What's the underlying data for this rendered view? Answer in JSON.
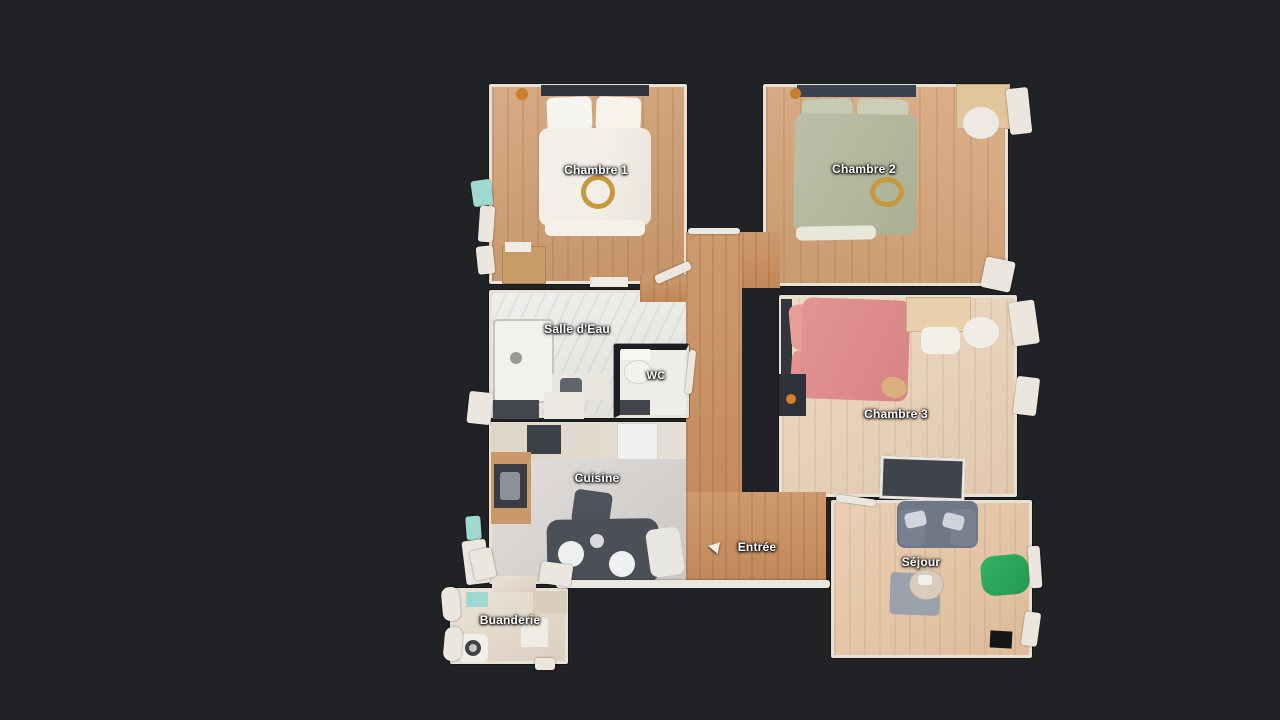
{
  "view": {
    "type": "3d-dollhouse-floorplan-top-view",
    "background": "#212226"
  },
  "rooms": [
    {
      "id": "chambre-1",
      "label": "Chambre 1",
      "floor": "#cf9b6d"
    },
    {
      "id": "chambre-2",
      "label": "Chambre 2",
      "floor": "#d6a478"
    },
    {
      "id": "salle-deau",
      "label": "Salle d'Eau",
      "floor": "#e9e7e3"
    },
    {
      "id": "wc",
      "label": "WC",
      "floor": "#efede8"
    },
    {
      "id": "cuisine",
      "label": "Cuisine",
      "floor": "#d8d4d1"
    },
    {
      "id": "chambre-3",
      "label": "Chambre 3",
      "floor": "#e9cfb4"
    },
    {
      "id": "entree",
      "label": "Entrée",
      "floor": "#c88e5d"
    },
    {
      "id": "sejour",
      "label": "Séjour",
      "floor": "#e6c3a1"
    },
    {
      "id": "buanderie",
      "label": "Buanderie",
      "floor": "#e4d8ca"
    }
  ],
  "palette": {
    "background": "#212226",
    "wall": "#e8e2d6",
    "bed_chambre1": "#efebe4",
    "bed_chambre2": "#b5b9a1",
    "bed_chambre3": "#de8d8c",
    "headboard_dark": "#3a4150",
    "sofa": "#6e7887",
    "pouf_green": "#2baa5e",
    "rug": "#9aa1ab",
    "kitchen_table": "#4b5057",
    "decor_gold": "#c6993f",
    "accent_teal": "#9fd8cf"
  },
  "markers": {
    "entree_arrow": "left-arrow-icon"
  }
}
